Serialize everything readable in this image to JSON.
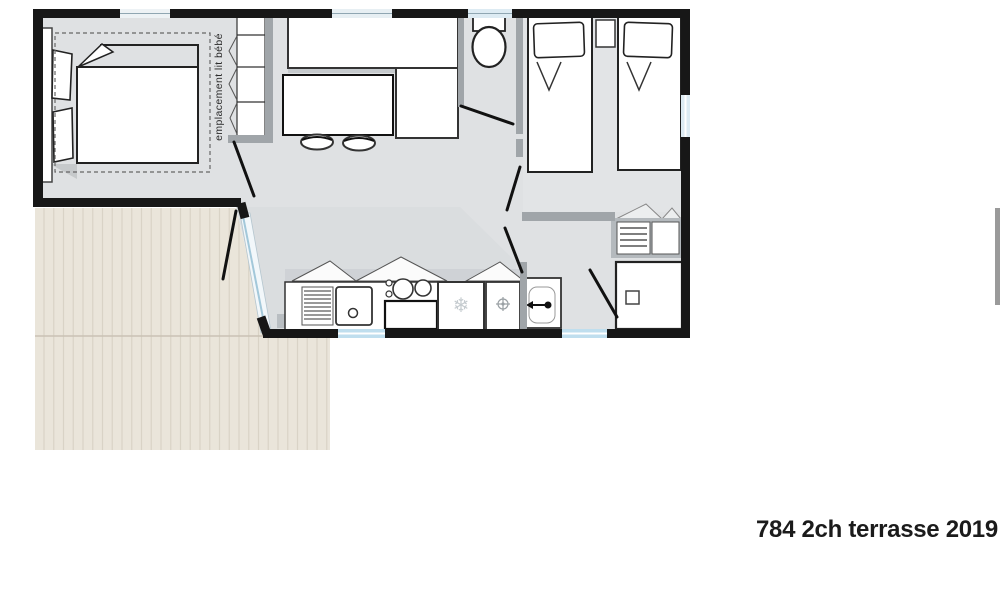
{
  "labels": {
    "baby_cot_area": "emplacement lit bébé",
    "plan_reference": "784 2ch terrasse 2019"
  },
  "icons": {
    "fridge_snowflake": "❄"
  },
  "palette": {
    "exterior_wall": "#171717",
    "interior_wall": "#a0a5a9",
    "floor": "#dfe1e3",
    "bedroom2_floor": "#e2e4e6",
    "terrace_deck": "#eae5da",
    "terrace_plank_line": "#d9d3c6",
    "window_glass": "#bfdeee",
    "window_pale": "#ddebf3",
    "furniture_outline": "#222222",
    "door_leaf": "#111111"
  }
}
